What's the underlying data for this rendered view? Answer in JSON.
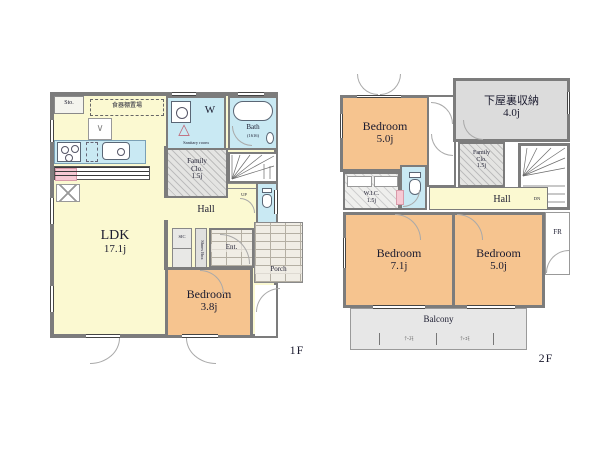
{
  "f1": {
    "label": "1F",
    "ldk": "LDK",
    "ldk_size": "17.1j",
    "bedroom": "Bedroom",
    "bedroom_size": "3.8j",
    "hall": "Hall",
    "up": "UP",
    "family_clo_1": "Family",
    "family_clo_2": "Clo.",
    "family_clo_3": "1.5j",
    "sanitary": "Sanitary room",
    "washer": "W",
    "bath": "Bath",
    "bath_note": "(1616)",
    "sto": "Sto.",
    "dish_shelf": "食器棚置場",
    "fridge": "R",
    "sic": "SIC",
    "shoes_box": "Shoes Box",
    "entrance": "Ent.",
    "porch": "Porch"
  },
  "f2": {
    "label": "2F",
    "bedroom1": "Bedroom",
    "bedroom1_size": "5.0j",
    "attic": "下屋裏収納",
    "attic_size": "4.0j",
    "family_clo_1": "Family",
    "family_clo_2": "Clo.",
    "family_clo_3": "1.5j",
    "wic": "W.I.C.",
    "wic_size": "1.5j",
    "hall": "Hall",
    "dn": "DN",
    "fr": "FR",
    "bedroom2": "Bedroom",
    "bedroom2_size": "7.1j",
    "bedroom3": "Bedroom",
    "bedroom3_size": "5.0j",
    "balcony": "Balcony",
    "balcony_mark1": "ﾃｰｽﾓ",
    "balcony_mark2": "ﾃ+ｴﾓ"
  },
  "icons": {
    "vanity_triangle": "△",
    "cabinet_mark": "∨"
  },
  "colors": {
    "wall": "#7c7c7c",
    "room_yellow": "#FBF9D1",
    "room_orange": "#F6C48F",
    "room_blue": "#C9E9F3",
    "room_gray": "#DCDCDC"
  }
}
